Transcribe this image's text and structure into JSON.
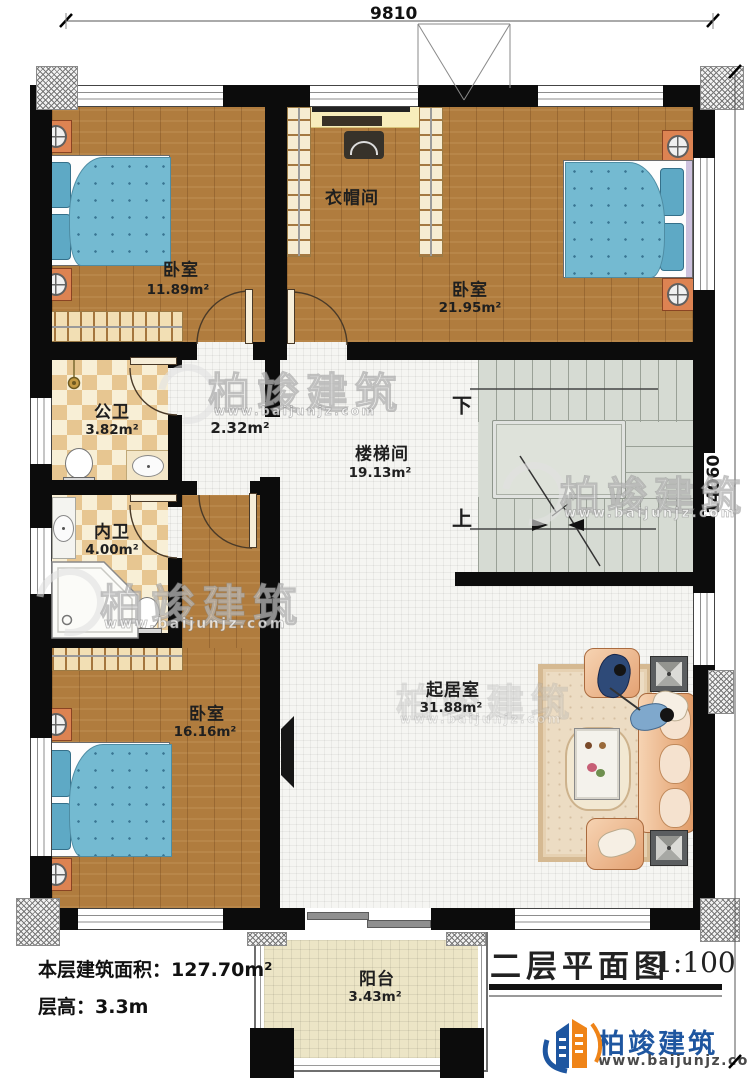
{
  "dimensions": {
    "top": "9810",
    "right": "14060"
  },
  "rooms": [
    {
      "id": "bedroom-top-left",
      "name": "卧室",
      "area": "11.89m²"
    },
    {
      "id": "cloakroom",
      "name": "衣帽间",
      "area": ""
    },
    {
      "id": "bedroom-top-right",
      "name": "卧室",
      "area": "21.95m²"
    },
    {
      "id": "public-bathroom",
      "name": "公卫",
      "area": "3.82m²"
    },
    {
      "id": "hallway",
      "name": "",
      "area": "2.32m²"
    },
    {
      "id": "stair-hall",
      "name": "楼梯间",
      "area": "19.13m²"
    },
    {
      "id": "private-bathroom",
      "name": "内卫",
      "area": "4.00m²"
    },
    {
      "id": "bedroom-bottom",
      "name": "卧室",
      "area": "16.16m²"
    },
    {
      "id": "living-room",
      "name": "起居室",
      "area": "31.88m²"
    },
    {
      "id": "balcony",
      "name": "阳台",
      "area": "3.43m²"
    }
  ],
  "stairs": {
    "down": "下",
    "up": "上"
  },
  "footer": {
    "floor_area": "本层建筑面积：127.70m²",
    "floor_height": "层高：3.3m"
  },
  "title_block": {
    "title": "二层平面图",
    "scale": "1:100"
  },
  "brand": {
    "name": "柏竣建筑",
    "url": "www.baijunjz.com",
    "blue": "#1e56a0",
    "orange": "#ef8418"
  },
  "watermark": {
    "name": "柏竣建筑",
    "url": "www.baijunjz.com"
  },
  "colors": {
    "wall": "#0c0c0c",
    "wood_floor": "#b07c3e",
    "bed_blue": "#74bad1",
    "sofa_peach": "#e8b488"
  }
}
